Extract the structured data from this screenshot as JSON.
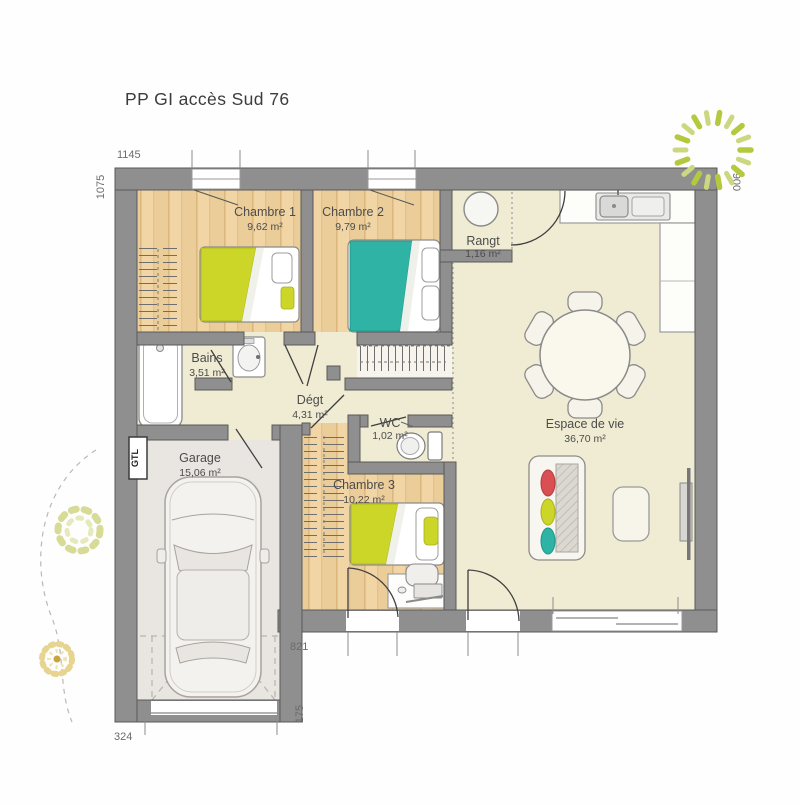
{
  "title": "PP GI accès Sud 76",
  "rooms": [
    {
      "name": "Chambre 1",
      "area": "9,62 m²"
    },
    {
      "name": "Chambre 2",
      "area": "9,79 m²"
    },
    {
      "name": "Rangt",
      "area": "1,16 m²"
    },
    {
      "name": "Bains",
      "area": "3,51 m²"
    },
    {
      "name": "Dégt",
      "area": "4,31 m²"
    },
    {
      "name": "WC",
      "area": "1,02 m²"
    },
    {
      "name": "Chambre 3",
      "area": "10,22 m²"
    },
    {
      "name": "Espace de vie",
      "area": "36,70 m²"
    },
    {
      "name": "Garage",
      "area": "15,06 m²"
    }
  ],
  "dimensions": {
    "top": "1145",
    "left": "1075",
    "right": "900",
    "bottom_step": "821",
    "garage_side": "175",
    "garage_bottom": "324"
  },
  "labels": {
    "gtl": "GTL"
  },
  "colors": {
    "wall": "#8f8f8f",
    "wood_floor": "#f0d3a1",
    "pale_floor": "#efecd3",
    "garage_floor": "#e9e5e1",
    "bed_yellow": "#ccd628",
    "bed_teal": "#2eb3a4",
    "cushion_red": "#d94f52",
    "compass_green": "#b4c93e"
  }
}
